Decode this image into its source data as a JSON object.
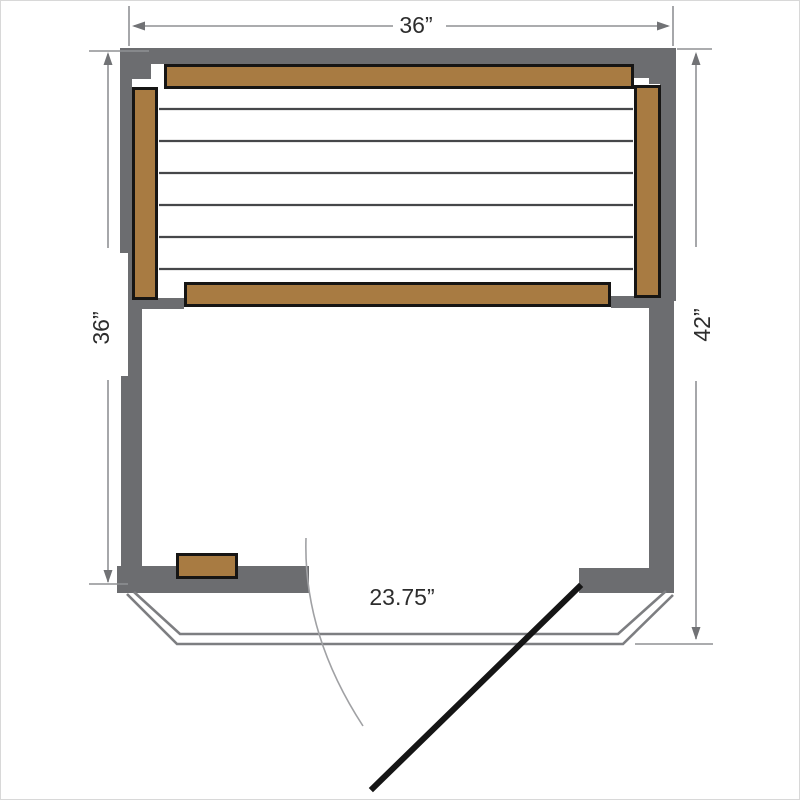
{
  "labels": {
    "width_top": "36”",
    "depth_left": "36”",
    "depth_right": "42”",
    "door_width": "23.75”"
  },
  "colors": {
    "wall": "#6c6d70",
    "bench": "#a87b42",
    "bench-border": "#161514",
    "slat": "#46474a",
    "glass": "#7d7e81",
    "arc": "#a0a1a4",
    "door": "#151515",
    "dim": "#8f9194",
    "arrow": "#717275",
    "label": "#2d2d2d",
    "page-border": "#d8d8d8",
    "bg": "#ffffff"
  }
}
